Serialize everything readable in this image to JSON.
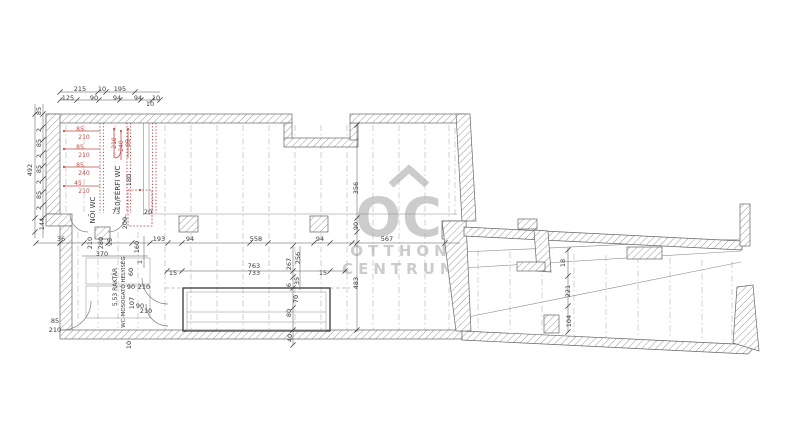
{
  "watermark": {
    "mark": "OC",
    "line1": "OTTHON",
    "line2": "CENTRUM"
  },
  "colors": {
    "ink": "#3a3a3a",
    "r": "#c0504d",
    "wall_outline": "#666666",
    "hatch": "#9a9a9a",
    "grid": "#b3b3b3",
    "thin": "#8c8c8c",
    "watermark_gray": "#c7c7c7",
    "background": "#ffffff"
  },
  "labels": [
    {
      "t": "215",
      "x": 80,
      "y": 91
    },
    {
      "t": "10",
      "x": 102,
      "y": 91
    },
    {
      "t": "195",
      "x": 120,
      "y": 91
    },
    {
      "t": "125",
      "x": 68,
      "y": 100
    },
    {
      "t": "90",
      "x": 94,
      "y": 100
    },
    {
      "t": "94",
      "x": 117,
      "y": 100
    },
    {
      "t": "94",
      "x": 138,
      "y": 100
    },
    {
      "t": "10",
      "x": 156,
      "y": 100
    },
    {
      "t": "10",
      "x": 150,
      "y": 106
    },
    {
      "t": "85",
      "x": 41,
      "y": 111,
      "r": -90
    },
    {
      "t": "2",
      "x": 41,
      "y": 130,
      "r": -90
    },
    {
      "t": "85",
      "x": 41,
      "y": 143,
      "r": -90
    },
    {
      "t": "2",
      "x": 41,
      "y": 156,
      "r": -90
    },
    {
      "t": "85",
      "x": 41,
      "y": 169,
      "r": -90
    },
    {
      "t": "2",
      "x": 41,
      "y": 182,
      "r": -90
    },
    {
      "t": "85",
      "x": 41,
      "y": 195,
      "r": -90
    },
    {
      "t": "2",
      "x": 41,
      "y": 208,
      "r": -90
    },
    {
      "t": "492",
      "x": 32,
      "y": 170,
      "r": -90
    },
    {
      "t": "144",
      "x": 44,
      "y": 224,
      "r": -90
    },
    {
      "t": "85",
      "x": 80,
      "y": 131,
      "c": "r",
      "s": 6
    },
    {
      "t": "210",
      "x": 84,
      "y": 139,
      "c": "r",
      "s": 6
    },
    {
      "t": "85",
      "x": 80,
      "y": 149,
      "c": "r",
      "s": 6
    },
    {
      "t": "210",
      "x": 84,
      "y": 157,
      "c": "r",
      "s": 6
    },
    {
      "t": "85",
      "x": 80,
      "y": 167,
      "c": "r",
      "s": 6
    },
    {
      "t": "240",
      "x": 84,
      "y": 175,
      "c": "r",
      "s": 6
    },
    {
      "t": "45",
      "x": 78,
      "y": 185,
      "c": "r",
      "s": 6
    },
    {
      "t": "210",
      "x": 84,
      "y": 193,
      "c": "r",
      "s": 6
    },
    {
      "t": "210",
      "x": 116,
      "y": 143,
      "r": -90,
      "c": "r",
      "s": 6
    },
    {
      "t": "240",
      "x": 123,
      "y": 146,
      "r": -90,
      "c": "r",
      "s": 6
    },
    {
      "t": "85",
      "x": 130,
      "y": 143,
      "r": -90,
      "c": "r",
      "s": 6
    },
    {
      "t": "NŐI WC",
      "x": 95,
      "y": 210,
      "r": -90,
      "s": 7
    },
    {
      "t": "10/FÉRFI WC",
      "x": 120,
      "y": 188,
      "r": -90,
      "s": 7
    },
    {
      "t": "180",
      "x": 131,
      "y": 180,
      "r": -90
    },
    {
      "t": "200",
      "x": 127,
      "y": 223,
      "r": -90
    },
    {
      "t": "73",
      "x": 116,
      "y": 214
    },
    {
      "t": "20",
      "x": 148,
      "y": 214
    },
    {
      "t": "36",
      "x": 61,
      "y": 241
    },
    {
      "t": "210",
      "x": 92,
      "y": 243,
      "r": -90
    },
    {
      "t": "280",
      "x": 103,
      "y": 243,
      "r": -90
    },
    {
      "t": "95",
      "x": 112,
      "y": 242,
      "r": -90
    },
    {
      "t": "160",
      "x": 139,
      "y": 247,
      "r": -90
    },
    {
      "t": "1",
      "x": 142,
      "y": 262,
      "r": -90
    },
    {
      "t": "370",
      "x": 102,
      "y": 256
    },
    {
      "t": "193",
      "x": 159,
      "y": 241
    },
    {
      "t": "94",
      "x": 190,
      "y": 241
    },
    {
      "t": "558",
      "x": 256,
      "y": 241
    },
    {
      "t": "94",
      "x": 320,
      "y": 241
    },
    {
      "t": "567",
      "x": 387,
      "y": 241
    },
    {
      "t": "15",
      "x": 173,
      "y": 275
    },
    {
      "t": "763",
      "x": 254,
      "y": 268
    },
    {
      "t": "733",
      "x": 254,
      "y": 275
    },
    {
      "t": "15",
      "x": 323,
      "y": 275
    },
    {
      "t": "256",
      "x": 300,
      "y": 258,
      "r": -90
    },
    {
      "t": "267",
      "x": 291,
      "y": 264,
      "r": -90
    },
    {
      "t": "35",
      "x": 299,
      "y": 281,
      "r": -90
    },
    {
      "t": "6",
      "x": 291,
      "y": 285,
      "r": -90
    },
    {
      "t": "70",
      "x": 298,
      "y": 299,
      "r": -90
    },
    {
      "t": "80",
      "x": 291,
      "y": 313,
      "r": -90
    },
    {
      "t": "40",
      "x": 292,
      "y": 338,
      "r": -90
    },
    {
      "t": "483",
      "x": 358,
      "y": 283,
      "r": -90
    },
    {
      "t": "90",
      "x": 358,
      "y": 226,
      "r": -90
    },
    {
      "t": "356",
      "x": 358,
      "y": 188,
      "r": -90
    },
    {
      "t": "5.53 RAKTÁR",
      "x": 117,
      "y": 287,
      "r": -90,
      "s": 6
    },
    {
      "t": "WC-MOSOGATÓ HELYISÉG",
      "x": 125,
      "y": 292,
      "r": -90,
      "s": 5.5
    },
    {
      "t": "60",
      "x": 133,
      "y": 272,
      "r": -90
    },
    {
      "t": "90",
      "x": 131,
      "y": 289
    },
    {
      "t": "210",
      "x": 144,
      "y": 289
    },
    {
      "t": "107",
      "x": 134,
      "y": 303,
      "r": -90
    },
    {
      "t": "90",
      "x": 140,
      "y": 308
    },
    {
      "t": "210",
      "x": 146,
      "y": 313
    },
    {
      "t": "85",
      "x": 55,
      "y": 323
    },
    {
      "t": "210",
      "x": 55,
      "y": 332
    },
    {
      "t": "10",
      "x": 131,
      "y": 345,
      "r": -90
    },
    {
      "t": "18",
      "x": 565,
      "y": 263,
      "r": -90
    },
    {
      "t": "221",
      "x": 570,
      "y": 291,
      "r": -90
    },
    {
      "t": "104",
      "x": 571,
      "y": 321,
      "r": -90
    }
  ]
}
